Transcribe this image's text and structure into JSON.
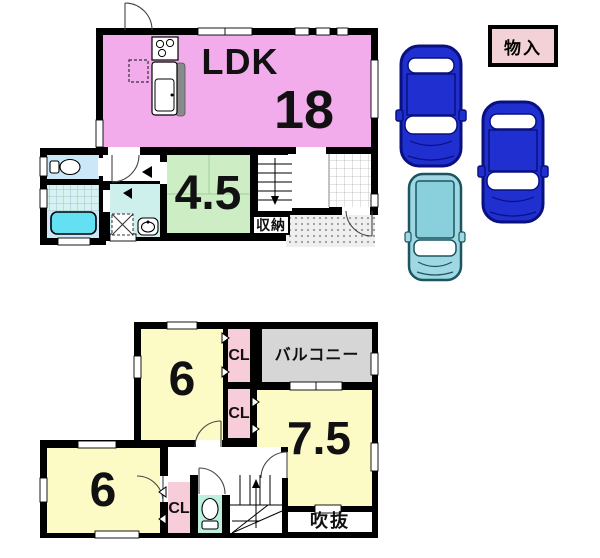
{
  "floor1": {
    "ldk_label": "LDK",
    "ldk_size": "18",
    "washitsu_size": "4.5",
    "storage_label": "収納"
  },
  "floor2": {
    "room6_top_size": "6",
    "room6_bottom_size": "6",
    "room75_size": "7.5",
    "cl_top_label": "CL",
    "cl_mid_label": "CL",
    "cl_bottom_label": "CL",
    "balcony_label": "バルコニー",
    "void_label": "吹抜"
  },
  "storage_box": {
    "label": "物入"
  },
  "cars": {
    "count": 3,
    "sedan_count": 2,
    "hatchback_count": 1
  },
  "colors": {
    "wall": "#000000",
    "ldk_pink": "#F2ACEC",
    "tatami_green": "#CDEDC4",
    "room_yellow": "#FCFAC5",
    "closet_pink": "#F6CDD8",
    "balcony_gray": "#D6D6D6",
    "bath_blue": "#CBE7F8",
    "bathtub_cyan": "#63E0F2",
    "washroom_cyan": "#CDF0EC",
    "toilet_mint": "#BEEEE0",
    "car_blue": "#1F2FD0",
    "car_outline_navy": "#0A1080",
    "car_teal": "#9FD8E2",
    "storage_box_pink": "#F2D2D6"
  }
}
